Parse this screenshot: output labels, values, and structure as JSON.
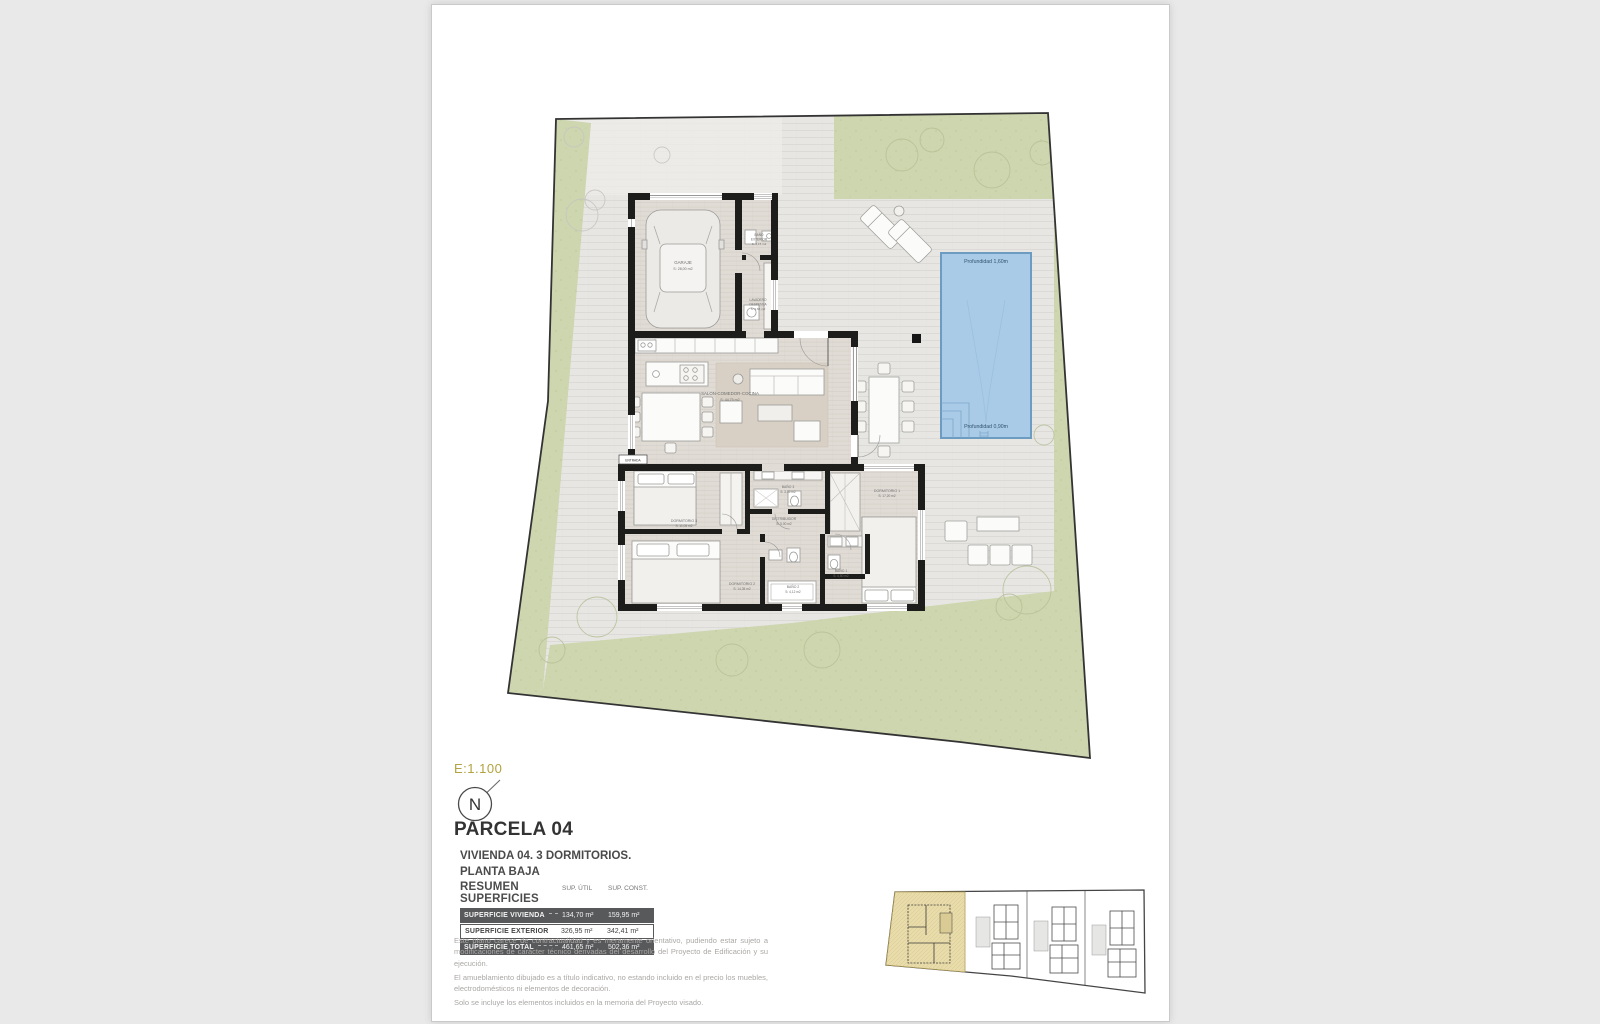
{
  "document": {
    "scale": "E:1.100",
    "north": "N",
    "parcel_title": "PARCELA 04",
    "subtitle_line1": "VIVIENDA 04. 3 DORMITORIOS.",
    "subtitle_line2": "PLANTA BAJA",
    "summary": {
      "heading": "RESUMEN SUPERFICIES",
      "col_util": "SUP. ÚTIL",
      "col_const": "SUP. CONST.",
      "rows": [
        {
          "label": "SUPERFICIE VIVIENDA",
          "util": "134,70 m²",
          "const": "159,95 m²"
        },
        {
          "label": "SUPERFICIE EXTERIOR",
          "util": "326,95 m²",
          "const": "342,41 m²"
        },
        {
          "label": "SUPERFICIE TOTAL",
          "util": "461,65 m²",
          "const": "502,36 m²"
        }
      ]
    },
    "disclaimer": {
      "p1": "Este plano carece de contractualidad y es meramente orientativo, pudiendo estar sujeto a modificaciones de carácter técnico derivadas del desarrollo del Proyecto de Edificación y su ejecución.",
      "p2": "El amueblamiento dibujado es a título indicativo, no estando incluido en el precio los muebles, electrodomésticos ni elementos de decoración.",
      "p3": "Solo se incluye los elementos incluidos en la memoria del Proyecto visado."
    }
  },
  "plan": {
    "rooms": {
      "garaje": {
        "name": "GARAJE",
        "area": "S: 28,00 m2"
      },
      "bano_exterior": {
        "l1": "BAÑO",
        "l2": "EXTERIOR",
        "area": "S: 4,15 m2"
      },
      "lavadero": {
        "l1": "LAVADERO",
        "l2": "DESPENSA",
        "area": "S: 3,65 m2"
      },
      "salon": {
        "name": "SALON-COMEDOR-COCINA",
        "area": "S: 44,75 m2"
      },
      "entrada": {
        "name": "ENTRADA"
      },
      "dormitorio3": {
        "name": "DORMITORIO 3",
        "area": "S: 11,05 m2"
      },
      "bano3": {
        "name": "BAÑO 3",
        "area": "S: 3,35 m2"
      },
      "distribuidor": {
        "name": "DISTRIBUIDOR",
        "area": "S: 5,00 m2"
      },
      "dormitorio2": {
        "name": "DORMITORIO 2",
        "area": "S: 14,35 m2"
      },
      "bano2": {
        "name": "BAÑO 2",
        "area": "S: 4,12 m2"
      },
      "bano1": {
        "name": "BAÑO 1",
        "area": "S: 4,50 m2"
      },
      "dormitorio1": {
        "name": "DORMITORIO 1",
        "area": "S: 17,20 m2"
      }
    },
    "pool": {
      "deep": "Profundidad 1,60m",
      "shallow": "Profundidad 0,90m"
    }
  },
  "colors": {
    "scale_accent": "#b3a23f",
    "pool_fill": "#a9cbe7",
    "pool_border": "#6d9cc2",
    "grass": "#cdd6ae",
    "wall": "#1d1d1b",
    "table_dark_row": "#58595b",
    "keyplan_highlight": "#e9dcab"
  }
}
